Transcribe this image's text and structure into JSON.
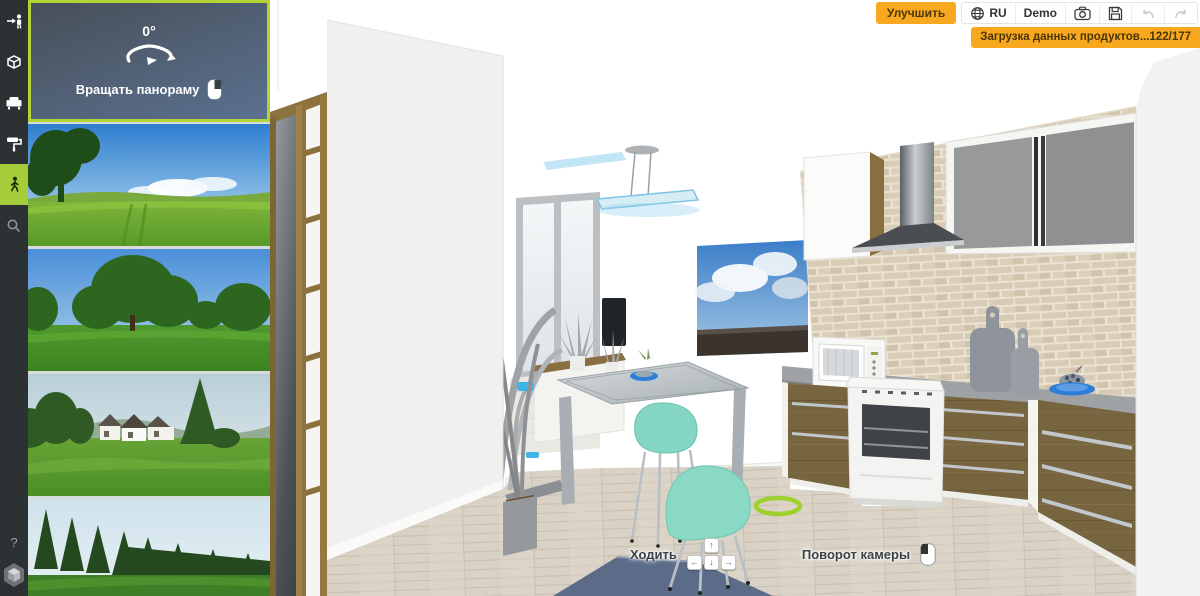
{
  "app_title": "3D interior planner — walk mode",
  "colors": {
    "accent_green": "#a5cd39",
    "panel_border_green": "#b3d435",
    "toolbar_orange": "#f7a81f",
    "sidebar_bg": "#2c3134",
    "rotate_panel_gradient_top": "#474f58",
    "rotate_panel_gradient_bottom": "#5b7190"
  },
  "sidebar": {
    "items": [
      {
        "name": "enter-walk",
        "icon": "walk-in-icon"
      },
      {
        "name": "rooms",
        "icon": "room-3d-icon"
      },
      {
        "name": "furniture",
        "icon": "sofa-icon"
      },
      {
        "name": "finishes",
        "icon": "paint-roller-icon"
      },
      {
        "name": "walk-mode",
        "icon": "walking-person-icon",
        "active": true
      },
      {
        "name": "search",
        "icon": "search-icon"
      }
    ],
    "help_label": "?"
  },
  "rotate_panel": {
    "angle_value": "0°",
    "label": "Вращать панораму",
    "mouse_hint": "right-button"
  },
  "panoramas": [
    {
      "name": "meadow-with-tree"
    },
    {
      "name": "park-trees"
    },
    {
      "name": "country-house"
    },
    {
      "name": "forest-edge"
    }
  ],
  "toolbar": {
    "improve_label": "Улучшить",
    "language_label": "RU",
    "demo_label": "Demo"
  },
  "toast": {
    "message": "Загрузка данных продуктов...122/177"
  },
  "walk_controls": {
    "walk_label": "Ходить",
    "camera_label": "Поворот камеры",
    "keys": {
      "up": "↑",
      "left": "←",
      "down": "↓",
      "right": "→"
    }
  }
}
